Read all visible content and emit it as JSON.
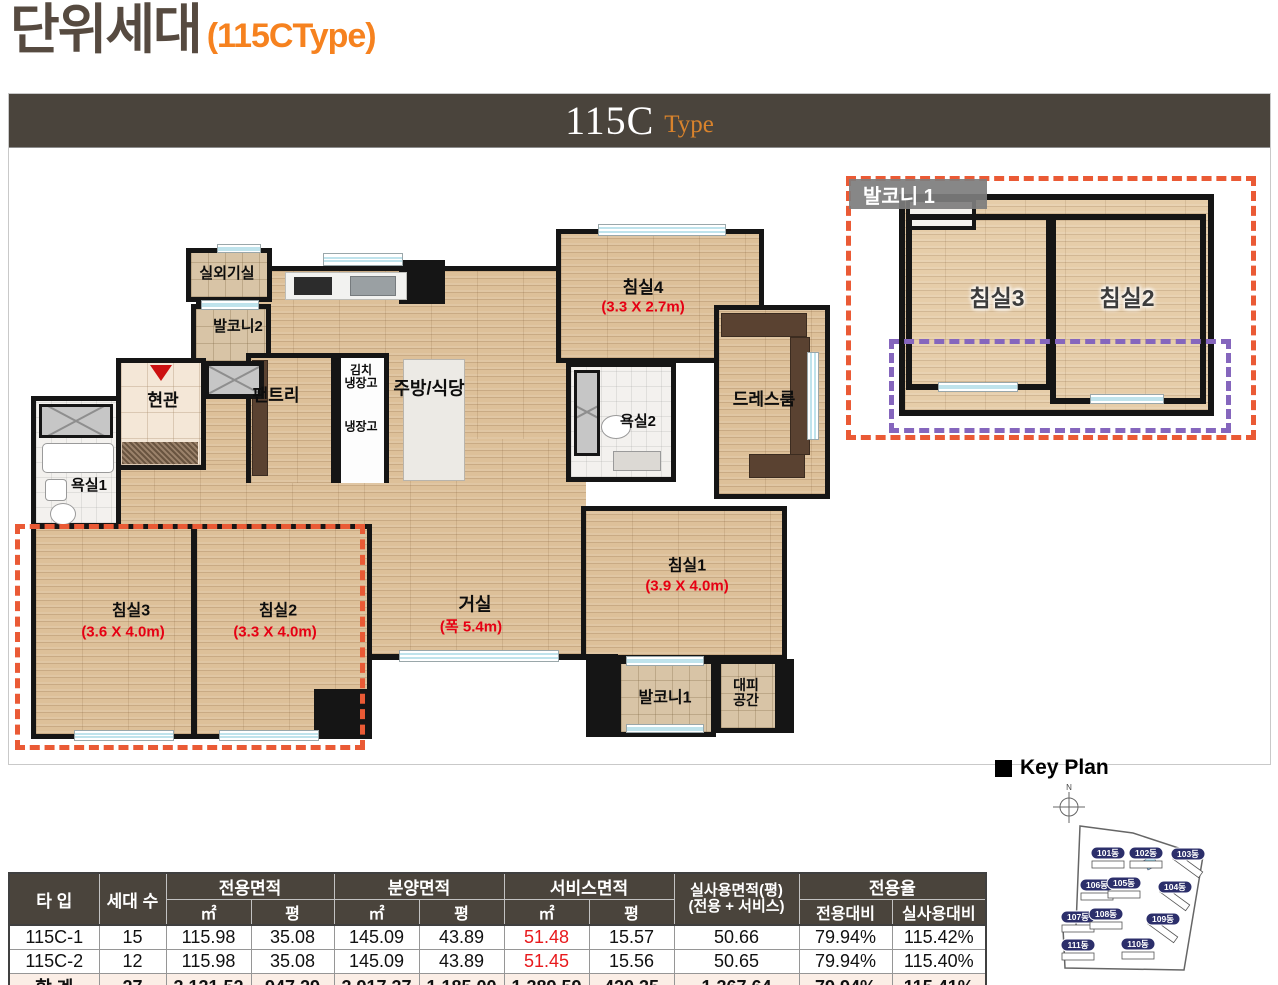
{
  "title": {
    "main": "단위세대",
    "sub": "(115CType)"
  },
  "banner": {
    "main": "115C",
    "sub": "Type"
  },
  "plan": {
    "labels": {
      "outdoor_unit": "실외기실",
      "balcony2": "발코니2",
      "entrance": "현관",
      "bath1": "욕실1",
      "pantry": "팬트리",
      "kimchi_fridge": "김치\n냉장고",
      "fridge": "냉장고",
      "kitchen": "주방/식당",
      "bed4": "침실4",
      "bed4_dim": "(3.3 X 2.7m)",
      "bath2": "욕실2",
      "dressroom": "드레스룸",
      "living": "거실",
      "living_dim": "(폭 5.4m)",
      "bed1": "침실1",
      "bed1_dim": "(3.9 X 4.0m)",
      "bed2": "침실2",
      "bed2_dim": "(3.3 X 4.0m)",
      "bed3": "침실3",
      "bed3_dim": "(3.6 X 4.0m)",
      "balcony1": "발코니1",
      "refuge": "대피\n공간"
    }
  },
  "inset": {
    "tag": "발코니 1",
    "bed3": "침실3",
    "bed2": "침실2"
  },
  "keyplan": {
    "heading": "Key Plan",
    "north": "N",
    "buildings": [
      "101동",
      "102동",
      "103동",
      "106동",
      "105동",
      "104동",
      "107동",
      "108동",
      "109동",
      "111동",
      "110동"
    ]
  },
  "table": {
    "h": {
      "type": "타 입",
      "units": "세대 수",
      "g1": "전용면적",
      "g2": "분양면적",
      "g3": "서비스면적",
      "g4a": "실사용면적(평)",
      "g4b": "(전용 + 서비스)",
      "g5": "전용율",
      "m2": "㎡",
      "py": "평",
      "s1": "전용대비",
      "s2": "실사용대비"
    },
    "rows": [
      {
        "c": [
          "115C-1",
          "15",
          "115.98",
          "35.08",
          "145.09",
          "43.89",
          "51.48",
          "15.57",
          "50.66",
          "79.94%",
          "115.42%"
        ]
      },
      {
        "c": [
          "115C-2",
          "12",
          "115.98",
          "35.08",
          "145.09",
          "43.89",
          "51.45",
          "15.56",
          "50.65",
          "79.94%",
          "115.40%"
        ]
      },
      {
        "c": [
          "합 계",
          "27",
          "3,131.52",
          "947.29",
          "3,917.37",
          "1,185.00",
          "1,389.59",
          "420.35",
          "1,367.64",
          "79.94%",
          "115.41%"
        ]
      }
    ]
  },
  "colors": {
    "title_brown": "#564a40",
    "accent_orange": "#f6821f",
    "banner_bg": "#4a443c",
    "dim_red": "#e60013",
    "dash_orange": "#ea5a35",
    "dash_purple": "#8566bd",
    "header_bg": "#4a443c",
    "total_row_bg": "#fbeee6",
    "pill_navy": "#2c2f6b",
    "wood_floor": "#ddc099"
  }
}
